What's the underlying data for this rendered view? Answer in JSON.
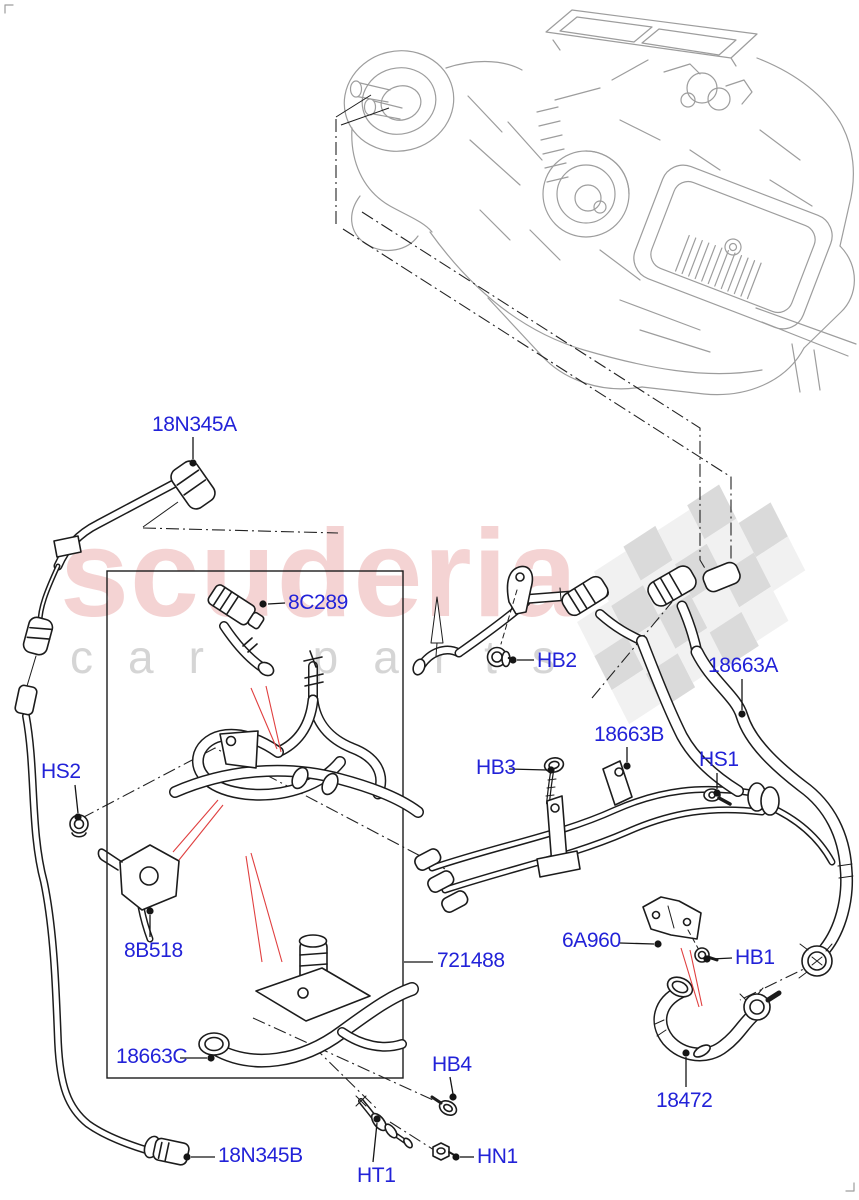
{
  "watermark": {
    "brand": "scuderia",
    "subbrand": "car parts",
    "brand_color": "#cd3737",
    "checker_dark": "#d7d7d7",
    "checker_light": "#f0f0f0"
  },
  "diagram": {
    "accent_color": "#2222d8",
    "callouts": [
      {
        "text": "18N345A",
        "label": [
          152,
          414
        ],
        "dot": [
          193,
          463
        ],
        "leader": [
          [
            193,
            437
          ],
          [
            193,
            459
          ]
        ]
      },
      {
        "text": "8C289",
        "label": [
          288,
          592
        ],
        "dot": [
          263,
          604
        ],
        "leader": [
          [
            285,
            603
          ],
          [
            268,
            604
          ]
        ]
      },
      {
        "text": "HB2",
        "label": [
          537,
          650
        ],
        "dot": [
          513,
          660
        ],
        "leader": [
          [
            534,
            660
          ],
          [
            517,
            660
          ]
        ]
      },
      {
        "text": "18663A",
        "label": [
          708,
          655
        ],
        "dot": [
          742,
          714
        ],
        "leader": [
          [
            742,
            679
          ],
          [
            742,
            710
          ]
        ]
      },
      {
        "text": "18663B",
        "label": [
          594,
          724
        ],
        "dot": [
          627,
          766
        ],
        "leader": [
          [
            627,
            747
          ],
          [
            627,
            762
          ]
        ]
      },
      {
        "text": "HB3",
        "label": [
          476,
          757
        ],
        "dot": [
          551,
          770
        ],
        "leader": [
          [
            509,
            769
          ],
          [
            547,
            770
          ]
        ]
      },
      {
        "text": "HS1",
        "label": [
          699,
          749
        ],
        "dot": [
          717,
          793
        ],
        "leader": [
          [
            717,
            773
          ],
          [
            717,
            789
          ]
        ]
      },
      {
        "text": "HS2",
        "label": [
          41,
          761
        ],
        "dot": [
          78,
          817
        ],
        "leader": [
          [
            75,
            785
          ],
          [
            78,
            813
          ]
        ]
      },
      {
        "text": "8B518",
        "label": [
          124,
          940
        ],
        "dot": [
          150,
          911
        ],
        "leader": [
          [
            150,
            937
          ],
          [
            150,
            915
          ]
        ]
      },
      {
        "text": "721488",
        "label": [
          437,
          950
        ],
        "dot": null,
        "leader": [
          [
            433,
            962
          ],
          [
            404,
            962
          ]
        ]
      },
      {
        "text": "6A960",
        "label": [
          562,
          930
        ],
        "dot": [
          658,
          944
        ],
        "leader": [
          [
            620,
            943
          ],
          [
            654,
            944
          ]
        ]
      },
      {
        "text": "HB1",
        "label": [
          735,
          947
        ],
        "dot": [
          707,
          959
        ],
        "leader": [
          [
            732,
            958
          ],
          [
            711,
            959
          ]
        ]
      },
      {
        "text": "18663C",
        "label": [
          116,
          1046
        ],
        "dot": [
          211,
          1058
        ],
        "leader": [
          [
            180,
            1058
          ],
          [
            207,
            1058
          ]
        ]
      },
      {
        "text": "HB4",
        "label": [
          432,
          1054
        ],
        "dot": [
          453,
          1097
        ],
        "leader": [
          [
            450,
            1077
          ],
          [
            453,
            1094
          ]
        ]
      },
      {
        "text": "18472",
        "label": [
          656,
          1090
        ],
        "dot": [
          686,
          1053
        ],
        "leader": [
          [
            686,
            1087
          ],
          [
            686,
            1057
          ]
        ]
      },
      {
        "text": "18N345B",
        "label": [
          218,
          1145
        ],
        "dot": [
          187,
          1157
        ],
        "leader": [
          [
            215,
            1157
          ],
          [
            191,
            1157
          ]
        ]
      },
      {
        "text": "HT1",
        "label": [
          357,
          1165
        ],
        "dot": [
          377,
          1119
        ],
        "leader": [
          [
            373,
            1162
          ],
          [
            377,
            1123
          ]
        ]
      },
      {
        "text": "HN1",
        "label": [
          477,
          1146
        ],
        "dot": [
          456,
          1157
        ],
        "leader": [
          [
            474,
            1157
          ],
          [
            460,
            1157
          ]
        ]
      }
    ]
  }
}
